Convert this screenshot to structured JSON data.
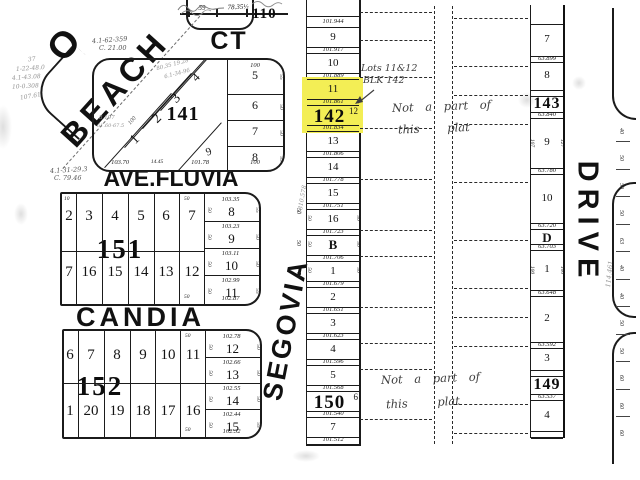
{
  "palette": {
    "ink": "#1b1b1b",
    "paper": "#ffffff",
    "highlight": "#f3ee55",
    "pencil": "#8e8e8e"
  },
  "streets": {
    "beach_prefix": "O",
    "beach": "BEACH",
    "ct": "CT",
    "ave_fluvia": "AVE.FLUVIA",
    "candia": "CANDIA",
    "segovia": "SEGOVIA",
    "drive": "DRIVE"
  },
  "top_edge": {
    "dim_left": "59",
    "dim_right": "78.35½",
    "partial_block_number": "110"
  },
  "block141": {
    "number": "141",
    "diagonal_lots": [
      "1",
      "2",
      "3",
      "4"
    ],
    "east_lots": [
      "5",
      "6",
      "7",
      "8"
    ],
    "south_lot": "9",
    "top_dim": "100",
    "east_side_dims": [
      "55",
      "50",
      "50",
      "55"
    ],
    "bottom_dims": [
      "103.70",
      "14.45",
      "101.78",
      "100"
    ],
    "pencil_notes": [
      "80.35 19.28",
      "6.1-34-96",
      "8.197",
      "61.60-67.5"
    ],
    "depth_dim": "100"
  },
  "block151": {
    "number": "151",
    "north_lots": [
      "2",
      "3",
      "4",
      "5",
      "6",
      "7"
    ],
    "south_lots": [
      "7",
      "16",
      "15",
      "14",
      "13",
      "12"
    ],
    "east_lots": [
      {
        "lot": "8",
        "dim": "103.35"
      },
      {
        "lot": "9",
        "dim": "103.23"
      },
      {
        "lot": "10",
        "dim": "103.11"
      },
      {
        "lot": "11",
        "dim": "102.99"
      }
    ],
    "east_bottom_dim": "102.87",
    "east_side_dims": [
      "55",
      "50",
      "50",
      "55"
    ],
    "west_side_dims": [
      "50",
      "50",
      "50",
      "50"
    ],
    "edge_dims": {
      "top_left": "10",
      "top_right": "50",
      "bottom_right": "50"
    }
  },
  "block152": {
    "number": "152",
    "north_lots": [
      "6",
      "7",
      "8",
      "9",
      "10",
      "11"
    ],
    "south_lots": [
      "1",
      "20",
      "19",
      "18",
      "17",
      "16"
    ],
    "east_lots": [
      {
        "lot": "12",
        "dim": "102.78"
      },
      {
        "lot": "13",
        "dim": "102.66"
      },
      {
        "lot": "14",
        "dim": "102.55"
      },
      {
        "lot": "15",
        "dim": "102.44"
      }
    ],
    "east_bottom_dim": "102.32",
    "east_side_dims": [
      "50",
      "50",
      "50",
      "55"
    ],
    "west_side_dims": [
      "50",
      "50",
      "50",
      "50"
    ],
    "edge_dims": {
      "top_right": "50",
      "bottom_right": "50"
    }
  },
  "center_strip": {
    "top_dim": "101.944",
    "rows": [
      {
        "lot": "9",
        "dim": "101.917"
      },
      {
        "lot": "10",
        "dim": "101.889"
      },
      {
        "lot": "11",
        "dim": "101.861",
        "highlight": true
      },
      {
        "lot": "12",
        "dim": "101.834",
        "highlight": true,
        "block": "142"
      },
      {
        "lot": "13",
        "dim": "101.806"
      },
      {
        "lot": "14",
        "dim": "101.778"
      },
      {
        "lot": "15",
        "dim": "101.751"
      },
      {
        "lot": "16",
        "dim": "101.723",
        "side_left": "50",
        "side_right": "50"
      },
      {
        "lot": "B",
        "dim": "101.706",
        "bold": true,
        "side_left": "50",
        "side_right": "50"
      },
      {
        "lot": "1",
        "dim": "101.679",
        "side_left": "50",
        "side_right": "50"
      },
      {
        "lot": "2",
        "dim": "101.651"
      },
      {
        "lot": "3",
        "dim": "101.623"
      },
      {
        "lot": "4",
        "dim": "101.596"
      },
      {
        "lot": "5",
        "dim": "101.568"
      },
      {
        "lot": "6",
        "dim": "101.540",
        "block": "150"
      },
      {
        "lot": "7",
        "dim": "101.512"
      }
    ]
  },
  "right_strip": {
    "rows": [
      {
        "lot": "7",
        "dim": "63.899",
        "h": 38
      },
      {
        "lot": "8",
        "h": 34
      },
      {
        "block": "143",
        "dim": "63.840",
        "h": 22
      },
      {
        "lot": "9",
        "dim": "63.780",
        "h": 56,
        "side_left": "107",
        "side_right": "127"
      },
      {
        "lot": "10",
        "dim": "63.720",
        "h": 55
      },
      {
        "lot": "D",
        "dim": "63.703",
        "h": 21,
        "bold": true
      },
      {
        "lot": "1",
        "dim": "63.648",
        "h": 46,
        "side_left": "100",
        "side_right": "100"
      },
      {
        "lot": "2",
        "dim": "63.592",
        "h": 52
      },
      {
        "lot": "3",
        "h": 28
      },
      {
        "block": "149",
        "dim": "63.537",
        "h": 24
      },
      {
        "lot": "4",
        "h": 37
      }
    ]
  },
  "annotations": {
    "survey_note_1a": "4.1-62-359",
    "survey_note_1b": "C. 21.00",
    "survey_note_2a": "4.1-31-29.3",
    "survey_note_2b": "C. 79.46",
    "margin_notes": [
      "37",
      "1-22-48.0",
      "4.1-43.08",
      "10-0.308",
      "107.61"
    ],
    "lots_callout_line1": "Lots 11&12",
    "lots_callout_line2": "BLK 142",
    "not_part_upper_1": "Not a part of",
    "not_part_upper_2": "this plat",
    "not_part_lower_1": "Not a part of",
    "not_part_lower_2": "this plat",
    "segovia_margin": "1310.578",
    "drive_margin": "114.461"
  },
  "drive_edge": {
    "numbers": [
      "40",
      "50",
      "50",
      "50",
      "63",
      "40",
      "40",
      "50",
      "50",
      "60",
      "60",
      "60"
    ]
  },
  "segovia_edge": {
    "numbers": [
      "50",
      "50",
      "50"
    ]
  }
}
